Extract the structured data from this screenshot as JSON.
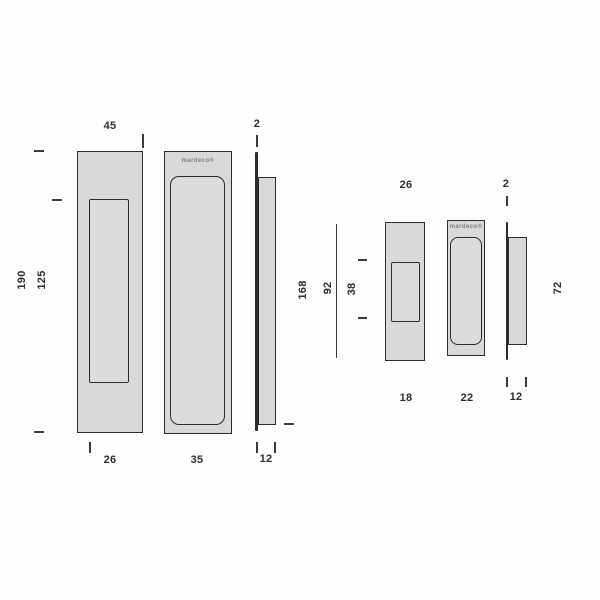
{
  "brand_logo": "mardeco®",
  "colors": {
    "background": "#fdfdfd",
    "fill": "#d9d9d9",
    "line": "#2c2c2c",
    "text": "#2e2e2e",
    "logo_text": "#7d7d7d"
  },
  "large_pull": {
    "faceplate_width": "45",
    "faceplate_height": "190",
    "recess_height": "125",
    "recess_width": "26",
    "logo_recess_width": "35",
    "plate_thickness": "2",
    "body_length": "168",
    "body_depth": "12"
  },
  "small_pull": {
    "faceplate_width": "26",
    "faceplate_height": "92",
    "recess_height": "38",
    "recess_width": "18",
    "logo_recess_width": "22",
    "plate_thickness": "2",
    "body_length": "72",
    "body_depth": "12"
  }
}
